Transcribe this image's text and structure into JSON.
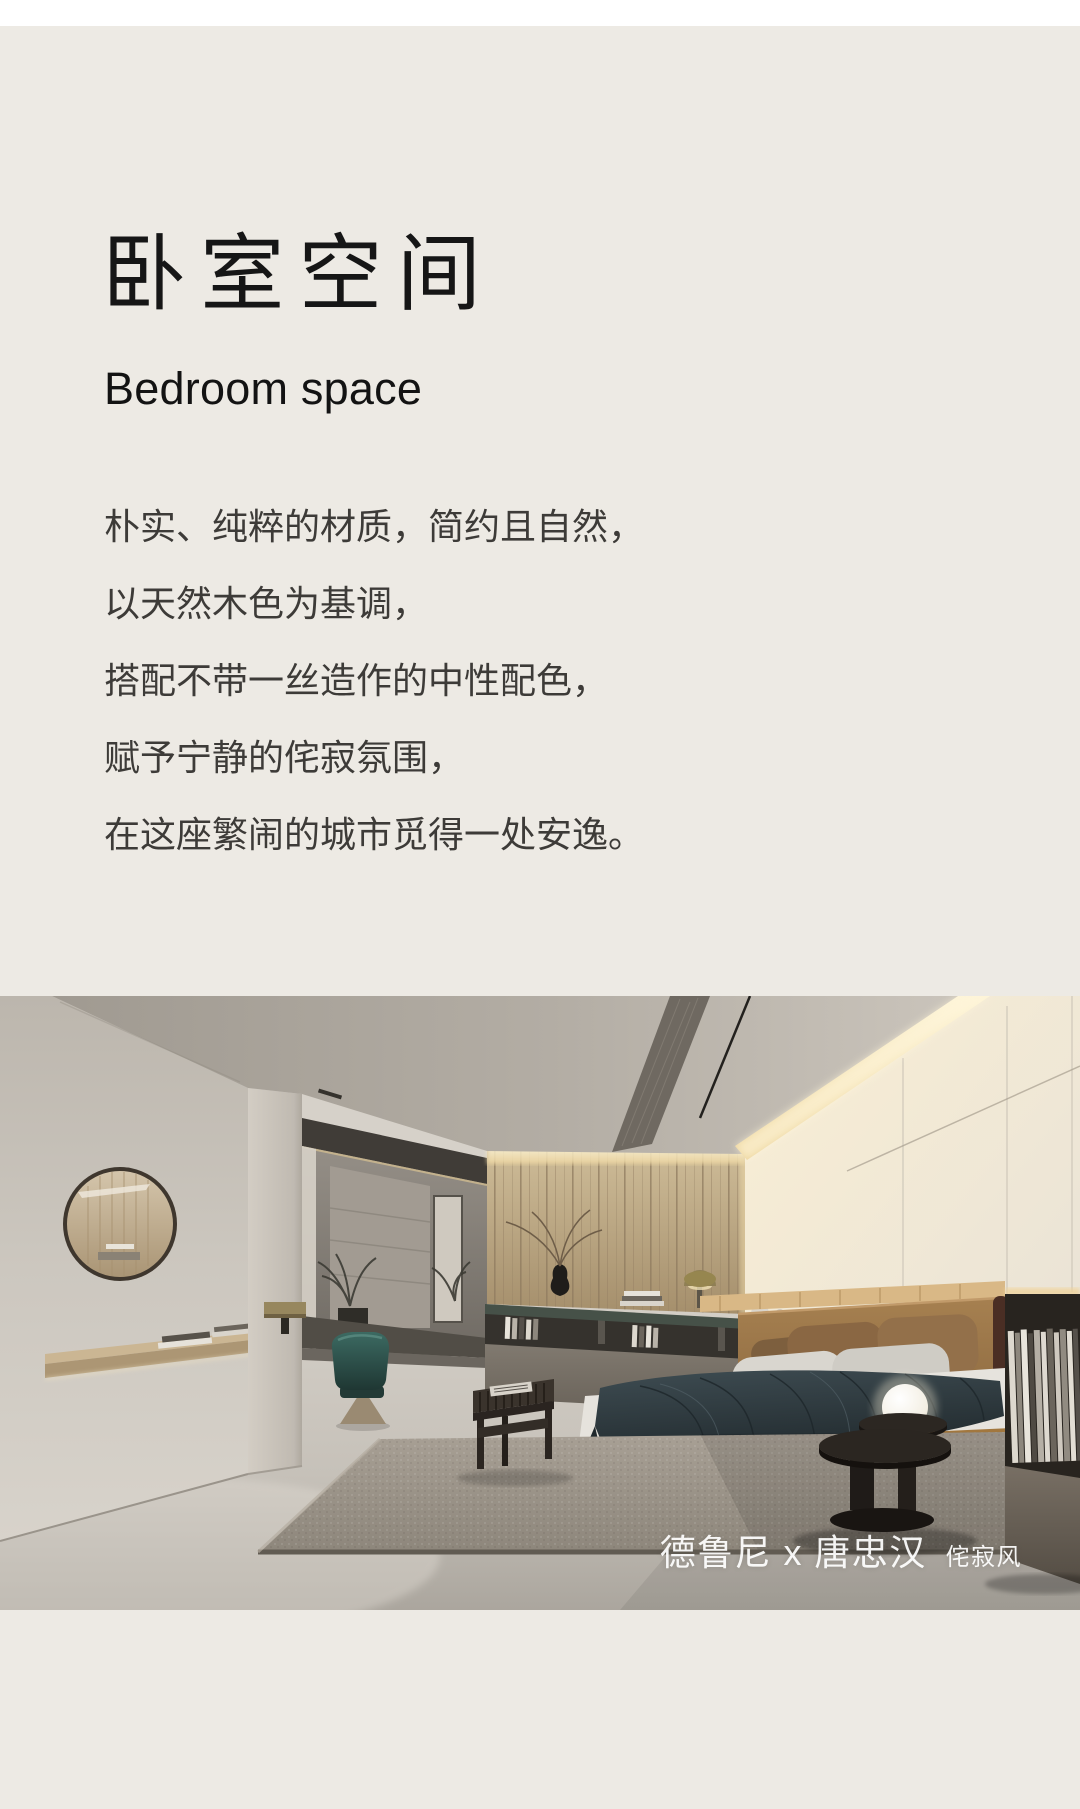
{
  "page": {
    "top_strip_color": "#ffffff",
    "background": "#edeae4"
  },
  "header": {
    "title_cn": "卧室空间",
    "title_en": "Bedroom space"
  },
  "description": {
    "lines": [
      "朴实、纯粹的材质，简约且自然，",
      "以天然木色为基调，",
      "搭配不带一丝造作的中性配色，",
      "赋予宁静的侘寂氛围，",
      "在这座繁闹的城市觅得一处安逸。"
    ]
  },
  "photo": {
    "label": "bedroom interior render",
    "watermark_brand": "德鲁尼 x 唐忠汉",
    "watermark_style": "侘寂风",
    "watermark_color": "#ffffff",
    "palette": {
      "wood_wall": "#b59d7c",
      "white_wall": "#efe7d6",
      "led_glow": "#f6e7bc",
      "bed_caramel": "#96703f",
      "blanket_teal": "#333e43",
      "rug_gray": "#9d968c",
      "floor": "#cfcac2"
    }
  }
}
